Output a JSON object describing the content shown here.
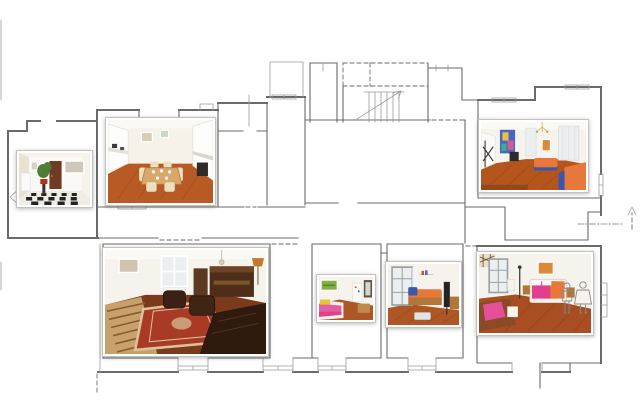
{
  "image": {
    "kind": "apartment floor plan with photo insets",
    "background": "#ffffff"
  },
  "colors": {
    "plan-line": "#6a6a6a",
    "plan-line-light": "#9b9b9b",
    "wall": "#f6f2ec",
    "wall-bright": "#fbf9f5",
    "wall-shade": "#e9e1d4",
    "floor-entry": "#efece5",
    "checker": "#26231f",
    "door": "#6e3b24",
    "plant": "#4e7d36",
    "pot": "#b23222",
    "cabinet": "#fdfdfb",
    "counter": "#2e2b28",
    "floor-kitchen": "#b75a24",
    "table": "#d8a868",
    "chair": "#ecdfc0",
    "floor-living": "#b5551e",
    "sofa-orange": "#e8773b",
    "blue": "#3a57ae",
    "art-blue": "#4a66c2",
    "yellow": "#e8c23c",
    "pink": "#e060a0",
    "magenta": "#e0408c",
    "green-art": "#7fb040",
    "orange-art": "#d88a3a",
    "floor-family": "#7c3a1c",
    "rug": "#a83a26",
    "rug-border": "#d9c49a",
    "leather": "#3a2114",
    "piano": "#4e2e18",
    "wood-mid": "#b07838",
    "lamp": "#c2762e",
    "frame-gray": "#9aa0a4",
    "pane": "#eceff0",
    "floor-bed": "#ad5626",
    "floor-bed3": "#a84e22"
  },
  "photos": [
    {
      "id": "entry-hall",
      "name": "entry hall photo (checkered floor, plant, dark door)"
    },
    {
      "id": "kitchen",
      "name": "kitchen and dining photo (white cabinets, wooden table, terracotta floor)"
    },
    {
      "id": "living-room",
      "name": "living room photo (colorful painting, orange daybeds, parquet floor)"
    },
    {
      "id": "sitting-room",
      "name": "sitting room photo (leather armchairs, oriental rug, piano)"
    },
    {
      "id": "bedroom-1",
      "name": "small bedroom photo (green artwork, pink bed)"
    },
    {
      "id": "bedroom-2",
      "name": "bedroom photo (orange sofa bed, tall window)"
    },
    {
      "id": "bedroom-3",
      "name": "master bedroom photo (pink double bed, desk)"
    }
  ],
  "plan_symbols": [
    {
      "id": "staircase",
      "name": "staircase with direction arrow"
    },
    {
      "id": "north-arrow",
      "name": "entrance / orientation arrow (dash-dot line)"
    },
    {
      "id": "scale-figures",
      "name": "two human scale figures"
    },
    {
      "id": "windows",
      "name": "window and door wall openings"
    }
  ]
}
